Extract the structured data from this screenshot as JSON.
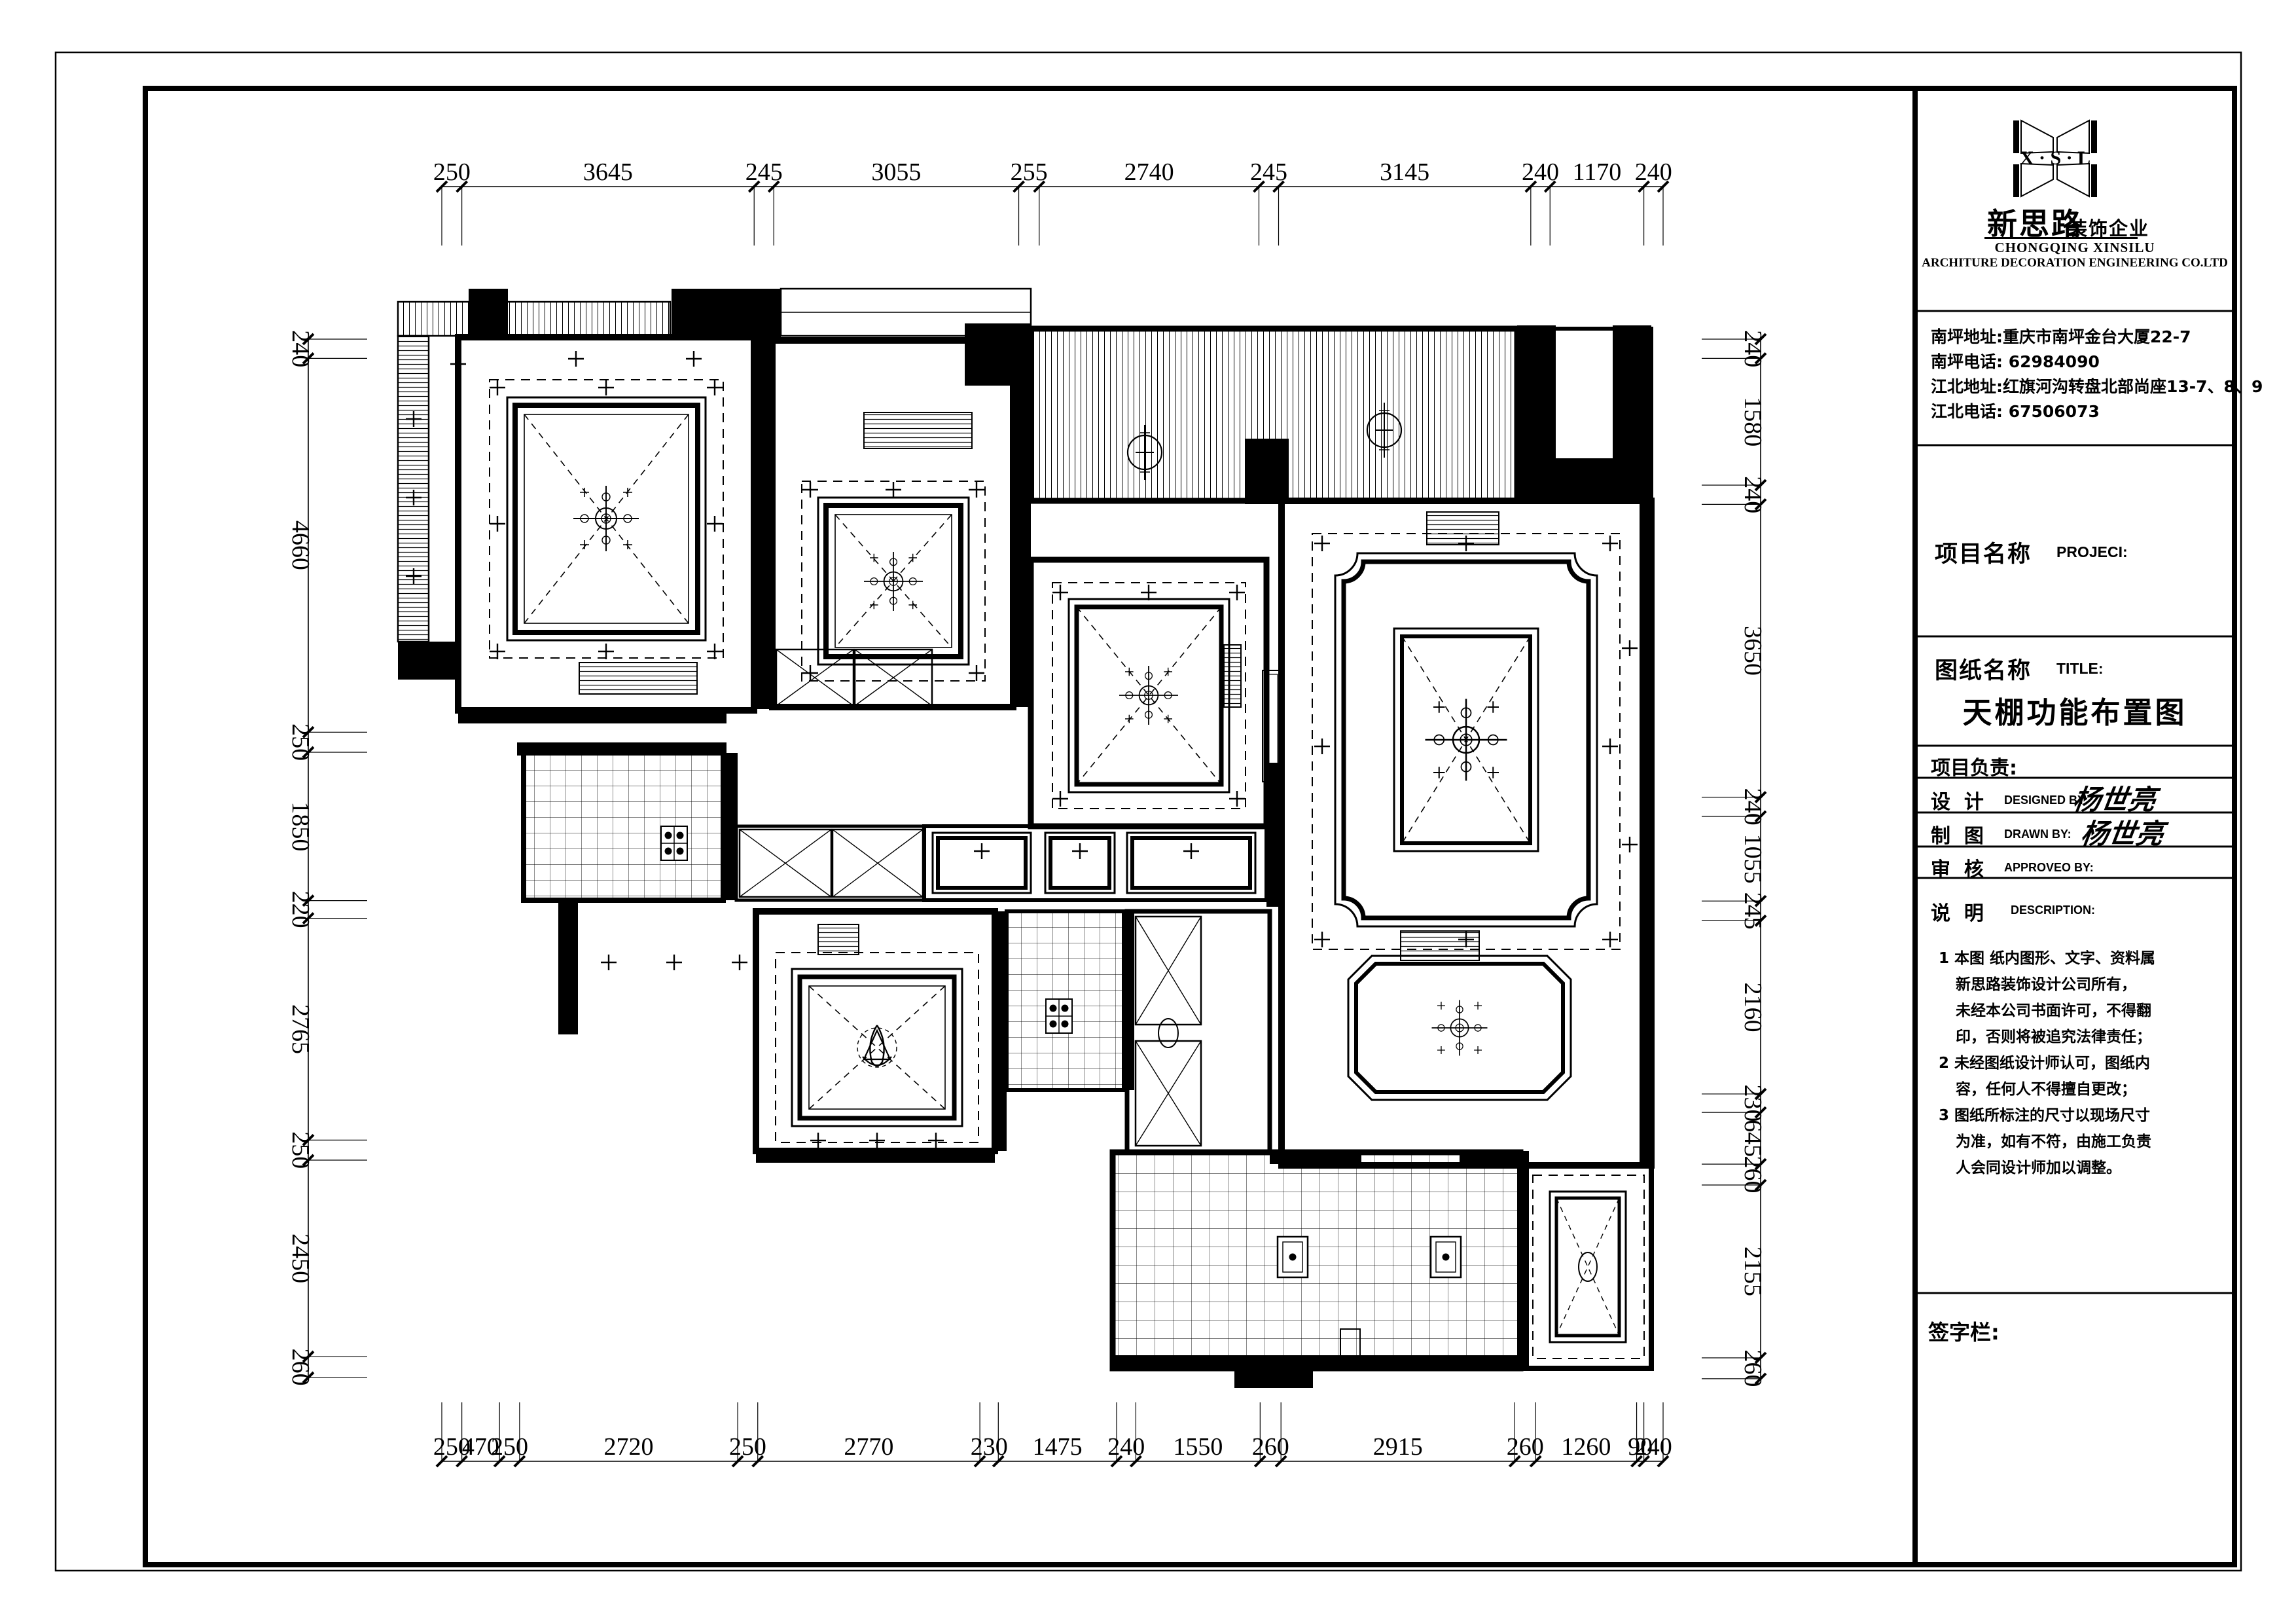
{
  "sheet": {
    "background": "#ffffff",
    "line_color": "#000000"
  },
  "dimensions": {
    "top": [
      "250",
      "3645",
      "245",
      "3055",
      "255",
      "2740",
      "245",
      "3145",
      "240",
      "1170",
      "240"
    ],
    "bottom": [
      "250",
      "470",
      "250",
      "2720",
      "250",
      "2770",
      "230",
      "1475",
      "240",
      "1550",
      "260",
      "2915",
      "260",
      "1260",
      "90",
      "240"
    ],
    "left": [
      "240",
      "4660",
      "250",
      "1850",
      "220",
      "2765",
      "250",
      "2450",
      "260"
    ],
    "right": [
      "240",
      "1580",
      "240",
      "3650",
      "240",
      "1055",
      "245",
      "2160",
      "230",
      "645",
      "260",
      "2155",
      "260"
    ]
  },
  "title_block": {
    "logo": {
      "letters": "X · S · L",
      "brand_cn": "新思路",
      "brand_suffix_cn": "装饰企业",
      "company_en_line1": "CHONGQING XINSILU",
      "company_en_line2": "ARCHITURE DECORATION ENGINEERING CO.LTD"
    },
    "contact_lines": [
      "南坪地址:重庆市南坪金台大厦22-7",
      "南坪电话: 62984090",
      "江北地址:红旗河沟转盘北部尚座13-7、8、9",
      "江北电话: 67506073"
    ],
    "project": {
      "label_cn": "项目名称",
      "label_en": "PROJECI:"
    },
    "sheet_title": {
      "label_cn": "图纸名称",
      "label_en": "TITLE:",
      "value": "天棚功能布置图"
    },
    "lead": {
      "label": "项目负责:"
    },
    "design": {
      "label_cn": "设  计",
      "label_en": "DESIGNED BY:",
      "value": "杨世亮"
    },
    "draft": {
      "label_cn": "制  图",
      "label_en": "DRAWN BY:",
      "value": "杨世亮"
    },
    "approve": {
      "label_cn": "审  核",
      "label_en": "APPROVEO BY:"
    },
    "description": {
      "label_cn": "说  明",
      "label_en": "DESCRIPTION:",
      "lines": [
        "1 本图 纸内图形、文字、资料属",
        "新思路装饰设计公司所有，",
        "未经本公司书面许可，不得翻",
        "印，否则将被追究法律责任；",
        "2 未经图纸设计师认可，图纸内",
        "容，任何人不得擅自更改；",
        "3 图纸所标注的尺寸以现场尺寸",
        "为准，如有不符，由施工负责",
        "人会同设计师加以调整。"
      ]
    },
    "signature": {
      "label": "签字栏:"
    }
  }
}
